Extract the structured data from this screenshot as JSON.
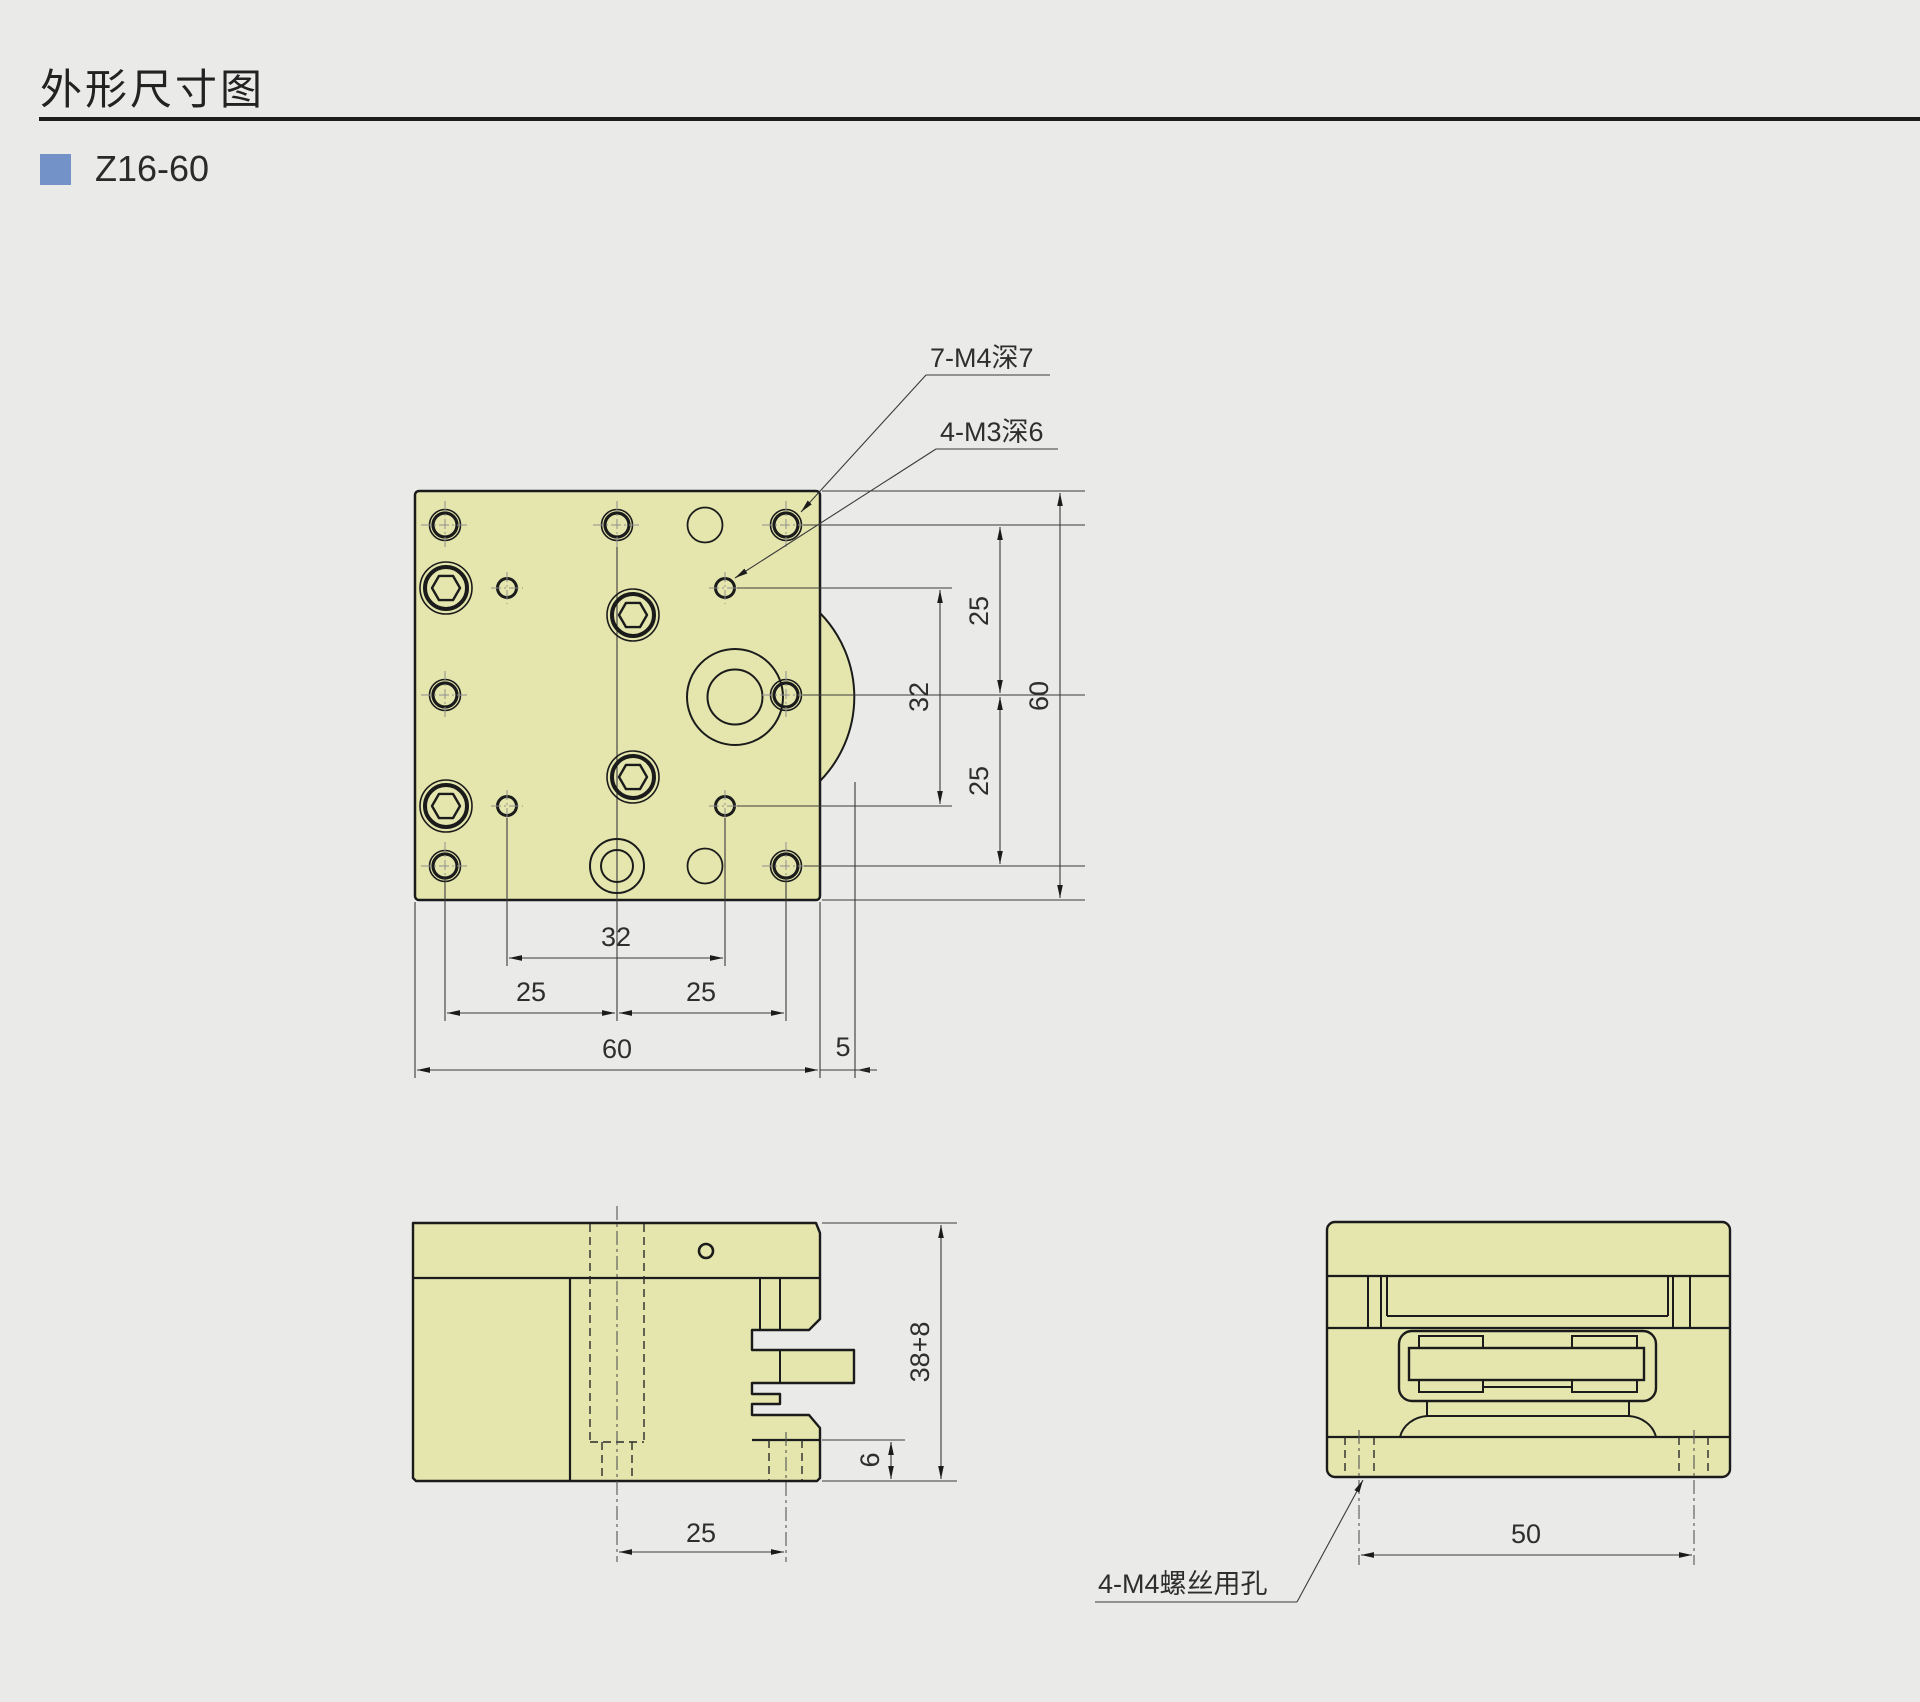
{
  "header": {
    "title": "外形尺寸图",
    "model": "Z16-60"
  },
  "colors": {
    "background": "#eaeae8",
    "part_fill": "#e4e6ae",
    "outline": "#1b1b1b",
    "dimension_line": "#3a3a3a",
    "accent": "#7292c8"
  },
  "callouts": {
    "m4_tapped": "7-M4深7",
    "m3_tapped": "4-M3深6",
    "m4_clearance": "4-M4螺丝用孔"
  },
  "top_view": {
    "dim_right_25_top": "25",
    "dim_right_32": "32",
    "dim_right_25_bottom": "25",
    "dim_right_60": "60",
    "dim_bottom_32": "32",
    "dim_bottom_25_left": "25",
    "dim_bottom_25_right": "25",
    "dim_bottom_60": "60",
    "dim_bottom_5": "5"
  },
  "front_view": {
    "dim_25": "25",
    "dim_6": "6",
    "dim_height": "38+8"
  },
  "side_view": {
    "dim_50": "50"
  }
}
